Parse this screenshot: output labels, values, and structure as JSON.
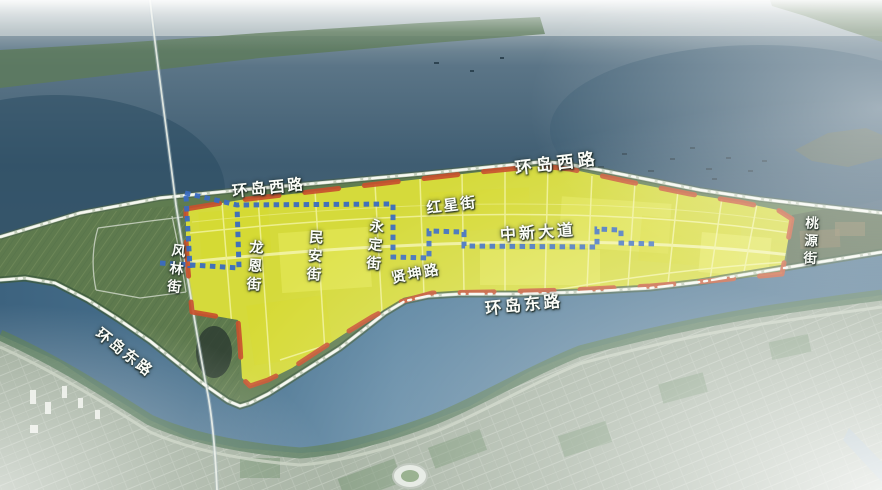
{
  "map": {
    "title": "island master-plan aerial map",
    "labels": {
      "ring_road_west_1": "环岛西路",
      "ring_road_west_2": "环岛西路",
      "ring_road_east_center": "环岛东路",
      "ring_road_east_southwest": "环岛东路",
      "hongxing_street": "红星街",
      "zhongxin_avenue": "中新大道",
      "xiankun_road": "贤坤路",
      "fenglin_street": "风林街",
      "longen_street": "龙恩街",
      "minan_street": "民安街",
      "yongding_street": "永定街",
      "taoyuan_street": "桃源街"
    },
    "colors": {
      "highlight_zone_fill": "#e0e23a",
      "zone_border_red": "#c8502e",
      "sub_boundary_blue": "#3a6cc0",
      "ring_road_dashline": "#f6f8f1",
      "island_green": "#5f7c50",
      "river_blue": "#4f7b99",
      "water_deep": "#3f5d72",
      "city_gray_green": "#9aa896",
      "label_text": "#fafcf7"
    }
  }
}
